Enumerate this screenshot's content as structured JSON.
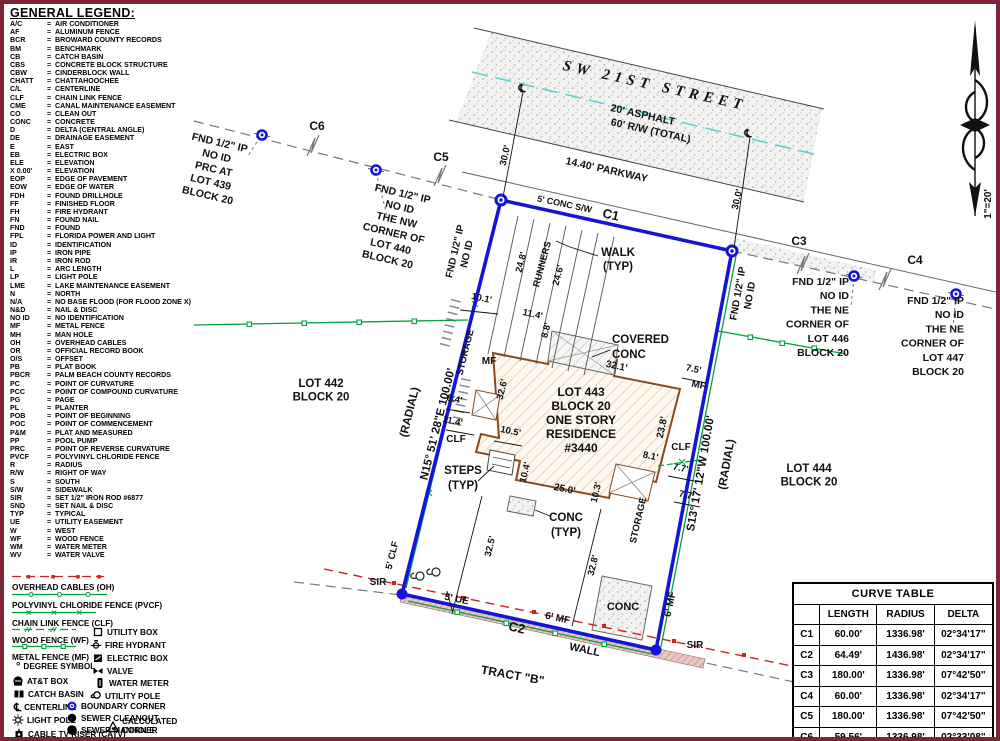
{
  "legend": {
    "title": "GENERAL LEGEND:",
    "items": [
      {
        "abbr": "A/C",
        "meaning": "AIR CONDITIONER"
      },
      {
        "abbr": "AF",
        "meaning": "ALUMINUM FENCE"
      },
      {
        "abbr": "BCR",
        "meaning": "BROWARD COUNTY RECORDS"
      },
      {
        "abbr": "BM",
        "meaning": "BENCHMARK"
      },
      {
        "abbr": "CB",
        "meaning": "CATCH BASIN"
      },
      {
        "abbr": "CBS",
        "meaning": "CONCRETE BLOCK STRUCTURE"
      },
      {
        "abbr": "CBW",
        "meaning": "CINDERBLOCK WALL"
      },
      {
        "abbr": "CHATT",
        "meaning": "CHATTAHOOCHEE"
      },
      {
        "abbr": "C/L",
        "meaning": "CENTERLINE"
      },
      {
        "abbr": "CLF",
        "meaning": "CHAIN LINK FENCE"
      },
      {
        "abbr": "CME",
        "meaning": "CANAL MAINTENANCE EASEMENT"
      },
      {
        "abbr": "CO",
        "meaning": "CLEAN OUT"
      },
      {
        "abbr": "CONC",
        "meaning": "CONCRETE"
      },
      {
        "abbr": "D",
        "meaning": "DELTA (CENTRAL ANGLE)"
      },
      {
        "abbr": "DE",
        "meaning": "DRAINAGE EASEMENT"
      },
      {
        "abbr": "E",
        "meaning": "EAST"
      },
      {
        "abbr": "EB",
        "meaning": "ELECTRIC BOX"
      },
      {
        "abbr": "ELE",
        "meaning": "ELEVATION"
      },
      {
        "abbr": "X 0.00'",
        "meaning": "ELEVATION"
      },
      {
        "abbr": "EOP",
        "meaning": "EDGE OF PAVEMENT"
      },
      {
        "abbr": "EOW",
        "meaning": "EDGE OF WATER"
      },
      {
        "abbr": "FDH",
        "meaning": "FOUND DRILLHOLE"
      },
      {
        "abbr": "FF",
        "meaning": "FINISHED FLOOR"
      },
      {
        "abbr": "FH",
        "meaning": "FIRE HYDRANT"
      },
      {
        "abbr": "FN",
        "meaning": "FOUND NAIL"
      },
      {
        "abbr": "FND",
        "meaning": "FOUND"
      },
      {
        "abbr": "FPL",
        "meaning": "FLORIDA POWER AND LIGHT"
      },
      {
        "abbr": "ID",
        "meaning": "IDENTIFICATION"
      },
      {
        "abbr": "IP",
        "meaning": "IRON PIPE"
      },
      {
        "abbr": "IR",
        "meaning": "IRON ROD"
      },
      {
        "abbr": "L",
        "meaning": "ARC LENGTH"
      },
      {
        "abbr": "LP",
        "meaning": "LIGHT POLE"
      },
      {
        "abbr": "LME",
        "meaning": "LAKE MAINTENANCE EASEMENT"
      },
      {
        "abbr": "N",
        "meaning": "NORTH"
      },
      {
        "abbr": "N/A",
        "meaning": "NO BASE FLOOD (FOR FLOOD ZONE X)"
      },
      {
        "abbr": "N&D",
        "meaning": "NAIL & DISC"
      },
      {
        "abbr": "NO ID",
        "meaning": "NO IDENTIFICATION"
      },
      {
        "abbr": "MF",
        "meaning": "METAL FENCE"
      },
      {
        "abbr": "MH",
        "meaning": "MAN HOLE"
      },
      {
        "abbr": "OH",
        "meaning": "OVERHEAD CABLES"
      },
      {
        "abbr": "OR",
        "meaning": "OFFICIAL RECORD BOOK"
      },
      {
        "abbr": "O/S",
        "meaning": "OFFSET"
      },
      {
        "abbr": "PB",
        "meaning": "PLAT BOOK"
      },
      {
        "abbr": "PBCR",
        "meaning": "PALM BEACH COUNTY RECORDS"
      },
      {
        "abbr": "PC",
        "meaning": "POINT OF CURVATURE"
      },
      {
        "abbr": "PCC",
        "meaning": "POINT OF COMPOUND CURVATURE"
      },
      {
        "abbr": "PG",
        "meaning": "PAGE"
      },
      {
        "abbr": "PL",
        "meaning": "PLANTER"
      },
      {
        "abbr": "POB",
        "meaning": "POINT OF BEGINNING"
      },
      {
        "abbr": "POC",
        "meaning": "POINT OF COMMENCEMENT"
      },
      {
        "abbr": "P&M",
        "meaning": "PLAT AND MEASURED"
      },
      {
        "abbr": "PP",
        "meaning": "POOL PUMP"
      },
      {
        "abbr": "PRC",
        "meaning": "POINT OF REVERSE CURVATURE"
      },
      {
        "abbr": "PVCF",
        "meaning": "POLYVINYL CHLORIDE FENCE"
      },
      {
        "abbr": "R",
        "meaning": "RADIUS"
      },
      {
        "abbr": "R/W",
        "meaning": "RIGHT OF WAY"
      },
      {
        "abbr": "S",
        "meaning": "SOUTH"
      },
      {
        "abbr": "S/W",
        "meaning": "SIDEWALK"
      },
      {
        "abbr": "SIR",
        "meaning": "SET 1/2\" IRON ROD #6877"
      },
      {
        "abbr": "SND",
        "meaning": "SET NAIL & DISC"
      },
      {
        "abbr": "TYP",
        "meaning": "TYPICAL"
      },
      {
        "abbr": "UE",
        "meaning": "UTILITY EASEMENT"
      },
      {
        "abbr": "W",
        "meaning": "WEST"
      },
      {
        "abbr": "WF",
        "meaning": "WOOD FENCE"
      },
      {
        "abbr": "WM",
        "meaning": "WATER METER"
      },
      {
        "abbr": "WV",
        "meaning": "WATER VALVE"
      }
    ]
  },
  "symbol_legend": {
    "line_items": [
      {
        "id": "oh",
        "label": "OVERHEAD CABLES (OH)"
      },
      {
        "id": "pvcf",
        "label": "POLYVINYL CHLORIDE FENCE (PVCF)"
      },
      {
        "id": "clf",
        "label": "CHAIN LINK FENCE (CLF)"
      },
      {
        "id": "wf",
        "label": "WOOD FENCE (WF)"
      },
      {
        "id": "mf",
        "label": "METAL FENCE (MF)"
      }
    ],
    "icon_items": [
      {
        "id": "degree",
        "label": "DEGREE SYMBOL"
      },
      {
        "id": "att-box",
        "label": "AT&T BOX"
      },
      {
        "id": "catch-basin",
        "label": "CATCH BASIN"
      },
      {
        "id": "centerline",
        "label": "CENTERLINE"
      },
      {
        "id": "light-pole",
        "label": "LIGHT POLE"
      },
      {
        "id": "cable-tv-riser",
        "label": "CABLE TV RISER (CATV)"
      },
      {
        "id": "utility-box",
        "label": "UTILITY BOX"
      },
      {
        "id": "fire-hydrant",
        "label": "FIRE HYDRANT"
      },
      {
        "id": "electric-box",
        "label": "ELECTRIC BOX"
      },
      {
        "id": "valve",
        "label": "VALVE"
      },
      {
        "id": "water-meter",
        "label": "WATER METER"
      },
      {
        "id": "utility-pole",
        "label": "UTILITY POLE"
      },
      {
        "id": "boundary-corner",
        "label": "BOUNDARY CORNER"
      },
      {
        "id": "sewer-cleanout",
        "label": "SEWER CLEANOUT"
      },
      {
        "id": "sewer-manhole",
        "label": "SEWER MANHOLE"
      },
      {
        "id": "calculated-corner",
        "label": "CALCULATED CORNER"
      }
    ]
  },
  "curve_table": {
    "title": "CURVE TABLE",
    "headers": [
      "",
      "LENGTH",
      "RADIUS",
      "DELTA"
    ],
    "rows": [
      [
        "C1",
        "60.00'",
        "1336.98'",
        "02°34'17\""
      ],
      [
        "C2",
        "64.49'",
        "1436.98'",
        "02°34'17\""
      ],
      [
        "C3",
        "180.00'",
        "1336.98'",
        "07°42'50\""
      ],
      [
        "C4",
        "60.00'",
        "1336.98'",
        "02°34'17\""
      ],
      [
        "C5",
        "180.00'",
        "1336.98'",
        "07°42'50\""
      ],
      [
        "C6",
        "59.56'",
        "1336.98'",
        "02°33'08\""
      ]
    ]
  },
  "drawing": {
    "colors": {
      "boundary_blue": "#1515d8",
      "fence_green": "#00a33e",
      "overhead_red": "#cc2222",
      "centerline_cyan": "#55d5d5",
      "house_brown": "#8a4a1a",
      "frame_maroon": "#7a2634"
    },
    "labels": [
      {
        "id": "street-name",
        "text": "SW 21ST STREET",
        "x": 650,
        "y": 86,
        "r": 12.5,
        "s": 15,
        "cls": "street-title"
      },
      {
        "id": "asphalt",
        "text": "20' ASPHALT",
        "x": 638,
        "y": 114,
        "r": 12.5,
        "s": 10.5
      },
      {
        "id": "rw-total",
        "text": "60' R/W (TOTAL)",
        "x": 646,
        "y": 130,
        "r": 12.5,
        "s": 10.5
      },
      {
        "id": "parkway",
        "text": "14.40' PARKWAY",
        "x": 602,
        "y": 169,
        "r": 12.5,
        "s": 10.5
      },
      {
        "id": "conc-sw",
        "text": "5' CONC S/W",
        "x": 560,
        "y": 203,
        "r": 12,
        "s": 9
      },
      {
        "id": "curve-c1",
        "text": "C1",
        "x": 606,
        "y": 215,
        "r": 12,
        "s": 13
      },
      {
        "id": "dim-30-left",
        "text": "30.0'",
        "x": 504,
        "y": 152,
        "r": -77,
        "s": 9.5
      },
      {
        "id": "dim-30-right",
        "text": "30.0'",
        "x": 736,
        "y": 196,
        "r": -77,
        "s": 9.5
      },
      {
        "id": "centerline-sym-left",
        "text": "℄",
        "x": 518,
        "y": 88,
        "r": 0,
        "s": 11
      },
      {
        "id": "centerline-sym-right",
        "text": "℄",
        "x": 744,
        "y": 133,
        "r": 0,
        "s": 11
      },
      {
        "id": "curve-c6",
        "text": "C6",
        "x": 313,
        "y": 126,
        "r": 0,
        "s": 12
      },
      {
        "id": "curve-c5",
        "text": "C5",
        "x": 437,
        "y": 157,
        "r": 0,
        "s": 12
      },
      {
        "id": "curve-c3",
        "text": "C3",
        "x": 795,
        "y": 241,
        "r": 0,
        "s": 12
      },
      {
        "id": "curve-c4",
        "text": "C4",
        "x": 911,
        "y": 260,
        "r": 0,
        "s": 12
      },
      {
        "id": "fnd-lot439",
        "lines": [
          "FND 1/2\" IP",
          "NO ID",
          "PRC AT",
          "LOT 439",
          "BLOCK  20"
        ],
        "x": 215,
        "y": 142,
        "r": 13,
        "s": 10.5,
        "lh": 13.5
      },
      {
        "id": "fnd-lot440",
        "lines": [
          "FND 1/2\" IP",
          "NO ID",
          "THE NW",
          "CORNER OF",
          "LOT 440",
          "BLOCK  20"
        ],
        "x": 398,
        "y": 193,
        "r": 13,
        "s": 10.5,
        "lh": 13.5
      },
      {
        "id": "fnd-vert-left",
        "lines": [
          "FND 1/2\" IP",
          "NO ID"
        ],
        "x": 454,
        "y": 248,
        "r": -77,
        "s": 10,
        "lh": 12
      },
      {
        "id": "fnd-vert-right",
        "lines": [
          "FND 1/2\" IP",
          "NO ID"
        ],
        "x": 737,
        "y": 290,
        "r": -80,
        "s": 10,
        "lh": 12
      },
      {
        "id": "fnd-lot446",
        "lines": [
          "FND 1/2\" IP",
          "NO ID",
          "THE NE",
          "CORNER OF",
          "LOT 446",
          "BLOCK  20"
        ],
        "x": 845,
        "y": 281,
        "r": 0,
        "s": 10.5,
        "lh": 14.2,
        "anchor": "end"
      },
      {
        "id": "fnd-lot447",
        "lines": [
          "FND 1/2\" IP",
          "NO ID",
          "THE NE",
          "CORNER OF",
          "LOT 447",
          "BLOCK  20"
        ],
        "x": 960,
        "y": 300,
        "r": 0,
        "s": 10.5,
        "lh": 14.2,
        "anchor": "end"
      },
      {
        "id": "lot-442",
        "lines": [
          "LOT 442",
          "BLOCK 20"
        ],
        "x": 317,
        "y": 383,
        "r": 0,
        "s": 11.5,
        "lh": 13.5
      },
      {
        "id": "lot-444",
        "lines": [
          "LOT 444",
          "BLOCK 20"
        ],
        "x": 805,
        "y": 468,
        "r": 0,
        "s": 11.5,
        "lh": 13.5
      },
      {
        "id": "bearing-west",
        "text": "N15° 51' 28\"E  100.00'",
        "x": 437,
        "y": 421,
        "r": -76,
        "s": 11.5
      },
      {
        "id": "bearing-west-radial",
        "text": "(RADIAL)",
        "x": 409,
        "y": 409,
        "r": -76,
        "s": 11.5
      },
      {
        "id": "bearing-east",
        "text": "S13° 17' 12\"W  100.00'",
        "x": 700,
        "y": 470,
        "r": -80,
        "s": 11.5
      },
      {
        "id": "bearing-east-radial",
        "text": "(RADIAL)",
        "x": 726,
        "y": 461,
        "r": -80,
        "s": 11.5
      },
      {
        "id": "runners",
        "text": "RUNNERS",
        "x": 541,
        "y": 261,
        "r": -75,
        "s": 9.5
      },
      {
        "id": "dim-24-8",
        "text": "24.8'",
        "x": 520,
        "y": 259,
        "r": -75,
        "s": 9.5
      },
      {
        "id": "dim-24-6",
        "text": "24.6'",
        "x": 557,
        "y": 272,
        "r": -75,
        "s": 9.5
      },
      {
        "id": "walk-typ",
        "lines": [
          "WALK",
          "(TYP)"
        ],
        "x": 614,
        "y": 252,
        "r": 0,
        "s": 11.5,
        "lh": 14
      },
      {
        "id": "dim-10-1",
        "text": "10.1'",
        "x": 477,
        "y": 297,
        "r": 12,
        "s": 9.5
      },
      {
        "id": "dim-11-4-top",
        "text": "11.4'",
        "x": 528,
        "y": 313,
        "r": 12,
        "s": 9.5
      },
      {
        "id": "dim-8-8",
        "text": "8.8'",
        "x": 545,
        "y": 327,
        "r": -76,
        "s": 9.5
      },
      {
        "id": "covered-conc",
        "lines": [
          "COVERED",
          "CONC"
        ],
        "x": 608,
        "y": 339,
        "r": 0,
        "s": 11.5,
        "lh": 15,
        "anchor": "start"
      },
      {
        "id": "dim-32-1",
        "text": "32.1'",
        "x": 612,
        "y": 365,
        "r": 12,
        "s": 10
      },
      {
        "id": "dim-7-5",
        "text": "7.5'",
        "x": 689,
        "y": 368,
        "r": 12,
        "s": 9.5
      },
      {
        "id": "mf-right",
        "text": "MF",
        "x": 694,
        "y": 384,
        "r": 12,
        "s": 10
      },
      {
        "id": "dim-23-8",
        "text": "23.8'",
        "x": 661,
        "y": 424,
        "r": -78,
        "s": 10
      },
      {
        "id": "clf-right",
        "text": "CLF",
        "x": 677,
        "y": 446,
        "r": 0,
        "s": 10
      },
      {
        "id": "dim-8-1",
        "text": "8.1'",
        "x": 646,
        "y": 455,
        "r": 12,
        "s": 9.5
      },
      {
        "id": "dim-7-7-a",
        "text": "7.7'",
        "x": 676,
        "y": 467,
        "r": 12,
        "s": 9.5
      },
      {
        "id": "dim-7-7-b",
        "text": "7.7'",
        "x": 682,
        "y": 494,
        "r": 12,
        "s": 9.5
      },
      {
        "id": "dim-10-3",
        "text": "10.3'",
        "x": 595,
        "y": 489,
        "r": -77,
        "s": 9.5
      },
      {
        "id": "storage-se",
        "text": "STORAGE",
        "x": 637,
        "y": 517,
        "r": -77,
        "s": 9.5
      },
      {
        "id": "storage-west",
        "text": "STORAGE",
        "x": 464,
        "y": 349,
        "r": -76,
        "s": 9.5
      },
      {
        "id": "mf-west",
        "text": "MF",
        "x": 485,
        "y": 360,
        "r": 0,
        "s": 10
      },
      {
        "id": "dim-32-6",
        "text": "32.6'",
        "x": 501,
        "y": 386,
        "r": -76,
        "s": 9.5
      },
      {
        "id": "dim-8-4",
        "text": "8.4'",
        "x": 450,
        "y": 398,
        "r": 12,
        "s": 9.5
      },
      {
        "id": "dim-11-4-west",
        "text": "11.4'",
        "x": 448,
        "y": 420,
        "r": 12,
        "s": 9.5
      },
      {
        "id": "clf-west",
        "text": "CLF",
        "x": 452,
        "y": 438,
        "r": 0,
        "s": 10
      },
      {
        "id": "dim-10-5",
        "text": "10.5'",
        "x": 506,
        "y": 430,
        "r": 12,
        "s": 9.5
      },
      {
        "id": "steps-typ",
        "lines": [
          "STEPS",
          "(TYP)"
        ],
        "x": 459,
        "y": 470,
        "r": 0,
        "s": 11.5,
        "lh": 15
      },
      {
        "id": "dim-10-4",
        "text": "10.4'",
        "x": 524,
        "y": 469,
        "r": -76,
        "s": 9.5
      },
      {
        "id": "dim-25-0",
        "text": "25.0'",
        "x": 560,
        "y": 488,
        "r": 12,
        "s": 10
      },
      {
        "id": "conc-typ",
        "lines": [
          "CONC",
          "(TYP)"
        ],
        "x": 562,
        "y": 517,
        "r": 0,
        "s": 11.5,
        "lh": 15
      },
      {
        "id": "lot-443-block",
        "lines": [
          "LOT 443",
          "BLOCK 20",
          "ONE STORY",
          "RESIDENCE",
          "#3440"
        ],
        "x": 577,
        "y": 392,
        "r": 0,
        "s": 12,
        "lh": 14
      },
      {
        "id": "dim-32-5",
        "text": "32.5'",
        "x": 489,
        "y": 543,
        "r": -76,
        "s": 9.5
      },
      {
        "id": "dim-32-8",
        "text": "32.8'",
        "x": 592,
        "y": 562,
        "r": -76,
        "s": 9.5
      },
      {
        "id": "conc-bottom",
        "text": "CONC",
        "x": 619,
        "y": 606,
        "r": 0,
        "s": 11
      },
      {
        "id": "clf-5",
        "text": "5' CLF",
        "x": 391,
        "y": 552,
        "r": -76,
        "s": 9.5
      },
      {
        "id": "sir-left",
        "text": "SIR",
        "x": 374,
        "y": 581,
        "r": 0,
        "s": 10
      },
      {
        "id": "ue-5",
        "text": "5' UE",
        "x": 452,
        "y": 598,
        "r": 12,
        "s": 10
      },
      {
        "id": "mf-6-bottom",
        "text": "6' MF",
        "x": 553,
        "y": 617,
        "r": 12,
        "s": 10
      },
      {
        "id": "mf-6-right",
        "text": "6' MF",
        "x": 669,
        "y": 601,
        "r": -78,
        "s": 10
      },
      {
        "id": "curve-c2",
        "text": "C2",
        "x": 512,
        "y": 628,
        "r": 12,
        "s": 13
      },
      {
        "id": "wall",
        "text": "WALL",
        "x": 580,
        "y": 649,
        "r": 12,
        "s": 11
      },
      {
        "id": "sir-right",
        "text": "SIR",
        "x": 691,
        "y": 644,
        "r": 0,
        "s": 10
      },
      {
        "id": "tract-b",
        "text": "TRACT \"B\"",
        "x": 508,
        "y": 675,
        "r": 10,
        "s": 12
      },
      {
        "id": "scale-note",
        "text": "1\"=20'",
        "x": 987,
        "y": 200,
        "r": -90,
        "s": 10
      }
    ]
  }
}
